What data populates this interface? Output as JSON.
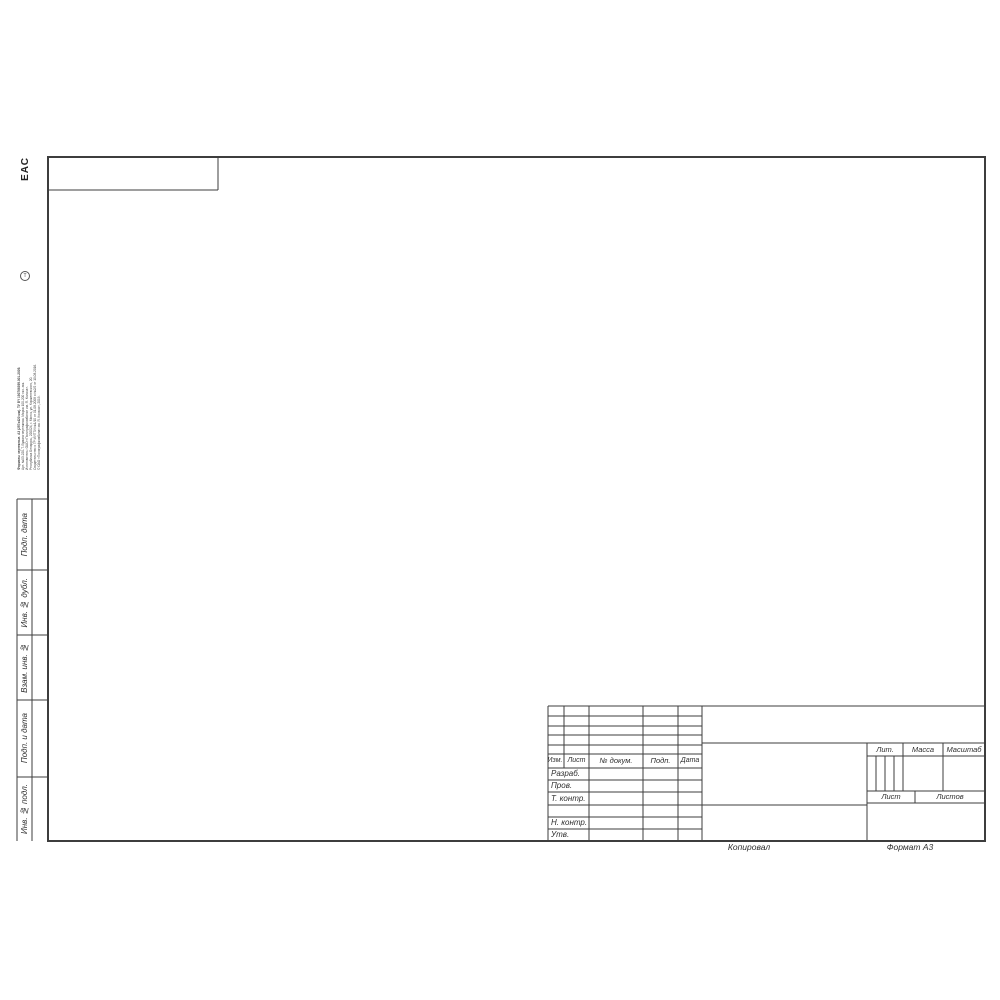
{
  "sheet": {
    "eac_mark": "ЕАС",
    "copied_label": "Копировал",
    "format_label": "Формат А3"
  },
  "imprint": {
    "icon": "Т",
    "lines": [
      "Форматы чертежные. А3 (297х420 мм). ТУ BY 190766399.001-2009.",
      "Арт. №03-220-Т. Бумага чертежная. Марка 100-200 экз. зак.",
      "Изготовитель: ОАО «Полиграфкомбинат им. Я. Коласа».",
      "Республика Беларусь, 220024, г. Минск, ул. Корженевского, 20.",
      "Свидетельство о ГР ИУПТИ №1/10 от 01.08.2008 и №2/2 от 10.08.2016.",
      "© ОАО «Полиграфкомбинат им. Я. Коласа», 2019."
    ]
  },
  "side_column": {
    "labels": [
      "Подп. дата",
      "Инв. № дубл.",
      "Взам. инв. №",
      "Подп. и дата",
      "Инв. № подл."
    ]
  },
  "title_block": {
    "revision_header": {
      "izm": "Изм.",
      "list": "Лист",
      "doc": "№ докум.",
      "podp": "Подп.",
      "data": "Дата"
    },
    "signature_rows": [
      "Разраб.",
      "Пров.",
      "Т. контр.",
      "",
      "Н. контр.",
      "Утв."
    ],
    "props_header": {
      "lit": "Лит.",
      "mass": "Масса",
      "scale": "Масштаб"
    },
    "sheet_row": {
      "list": "Лист",
      "listov": "Листов"
    }
  },
  "colors": {
    "paper": "#ffffff",
    "line": "#3d3d3d",
    "text": "#2f2f2f"
  }
}
